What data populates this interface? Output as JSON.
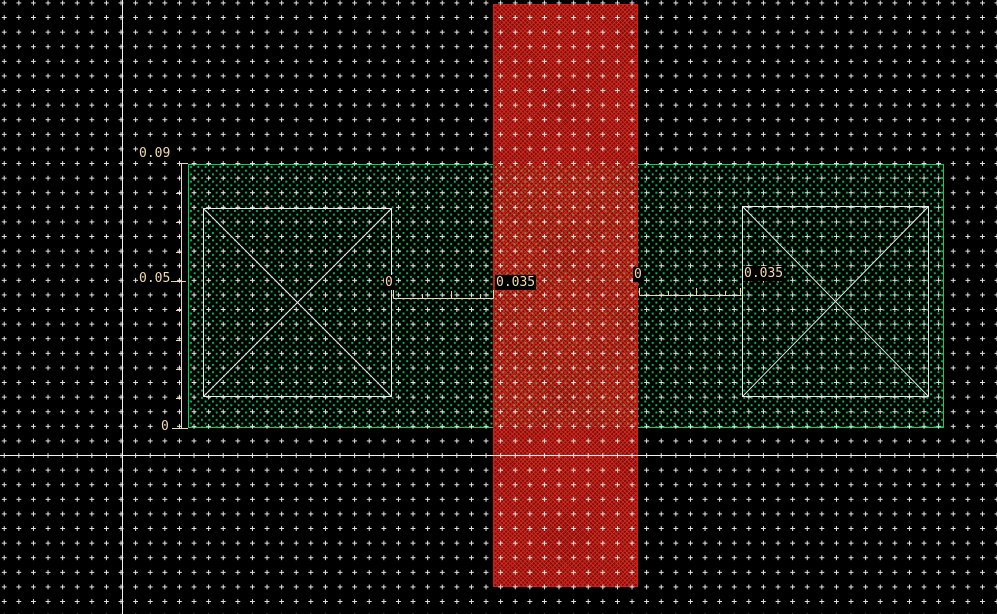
{
  "app": {
    "name": "ic-layout-editor-canvas",
    "view": "mask layout with dimension rulers"
  },
  "canvas": {
    "width_px": 997,
    "height_px": 614,
    "background": "#000000"
  },
  "colors": {
    "grid_dot": "#e9e9e9",
    "axis": "#f2f2f2",
    "ruler": "#ecd9a4",
    "label_text": "#f2dcab",
    "label_background": "#000000",
    "active_region_dot": "#00b44e",
    "active_region_border": "#00d75e",
    "poly_stripe_base": "#7a0f0f",
    "poly_stripe_hatch": "#da2b1c",
    "poly_stripe_border": "#e01212",
    "overlap_dot": "#8e7e40",
    "contact_outline": "#ededed"
  },
  "shapes": {
    "active_region": {
      "kind": "stippled-rectangle",
      "pattern": "green-dots"
    },
    "poly_stripe": {
      "kind": "hatched-rectangle",
      "pattern": "red-crosshatch"
    },
    "contact_left": {
      "kind": "outlined-square-with-x"
    },
    "contact_right": {
      "kind": "outlined-square-with-x"
    }
  },
  "measurements": {
    "left_ruler": {
      "top": "0.09",
      "middle": "0.05",
      "bottom": "0"
    },
    "left_gap": {
      "origin": "0",
      "width": "0.035"
    },
    "right_gap": {
      "origin": "0",
      "width": "0.035"
    }
  }
}
